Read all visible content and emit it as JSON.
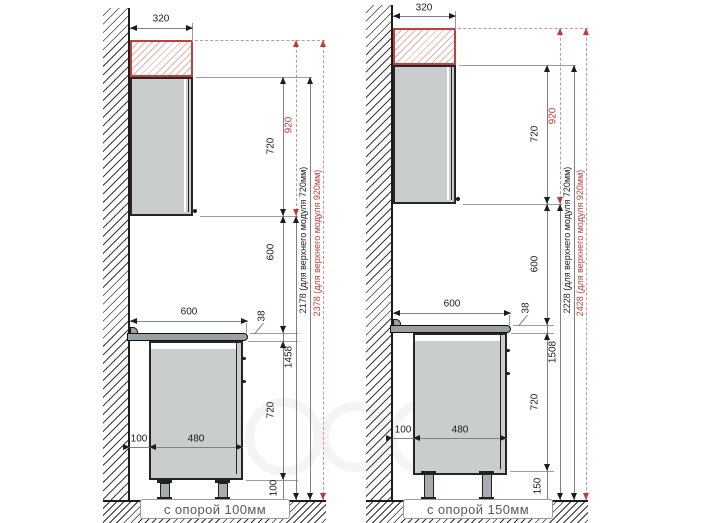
{
  "colors": {
    "accent_red": "#c03c3c",
    "cabinet_fill": "#c9cdcd",
    "countertop_fill": "#9aa0a3"
  },
  "left_diagram": {
    "caption": "с опорой 100мм",
    "dims": {
      "top_module_depth": "320",
      "upper_module_height": "720",
      "upper_module_height_tall": "920",
      "gap_height": "600",
      "countertop_width": "600",
      "countertop_thickness": "38",
      "floor_to_upper": "1458",
      "base_module_height": "720",
      "leg_height": "100",
      "wall_offset": "100",
      "base_body_width": "480",
      "total_standard": "2178 (для верхнего модуля 720мм)",
      "total_tall": "2378 (для верхнего модуля 920мм)"
    }
  },
  "right_diagram": {
    "caption": "с опорой 150мм",
    "dims": {
      "top_module_depth": "320",
      "upper_module_height": "720",
      "upper_module_height_tall": "920",
      "gap_height": "600",
      "countertop_width": "600",
      "countertop_thickness": "38",
      "floor_to_upper": "1508",
      "base_module_height": "720",
      "leg_height": "150",
      "wall_offset": "100",
      "base_body_width": "480",
      "total_standard": "2228 (для верхнего модуля 720мм)",
      "total_tall": "2428 (для верхнего модуля 920мм)"
    }
  }
}
